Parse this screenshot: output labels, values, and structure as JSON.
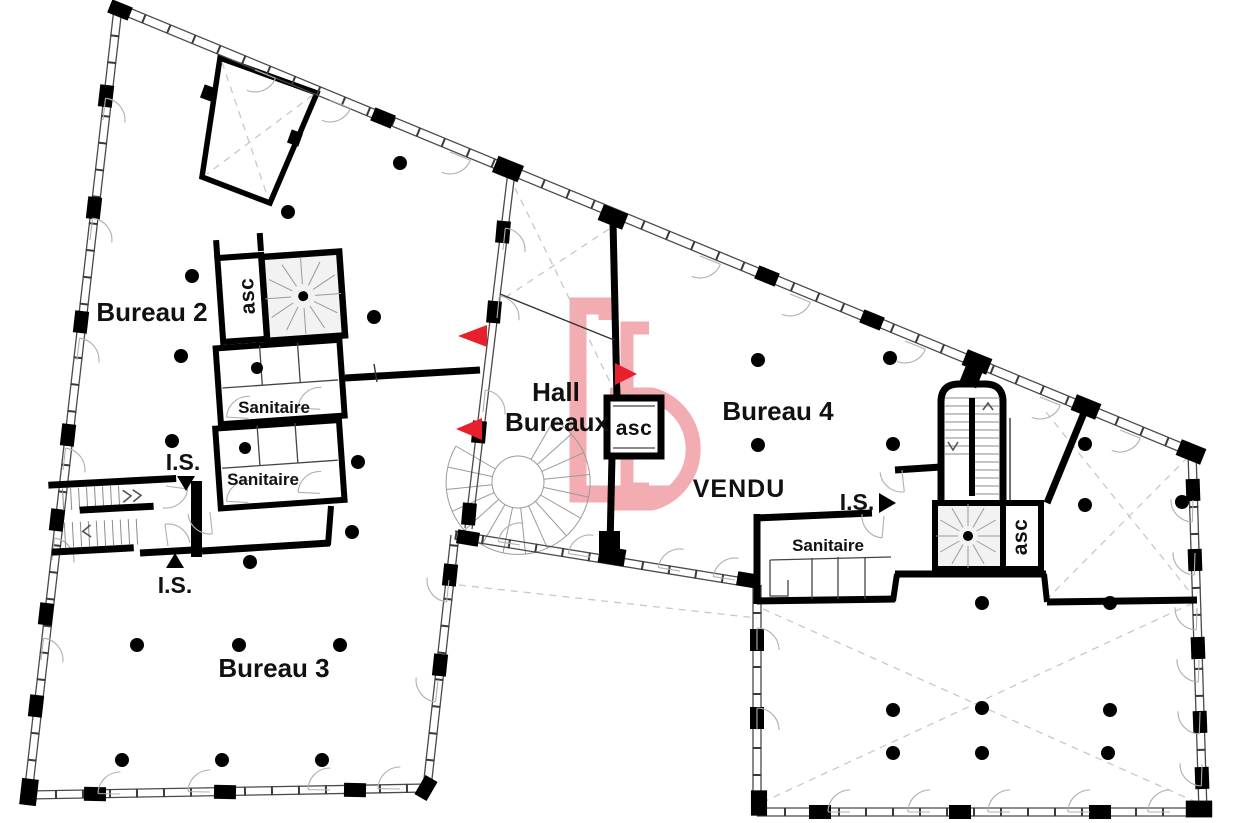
{
  "title": "Plan d'étage bureaux",
  "colors": {
    "wall": "#000000",
    "window_line": "#4a4a4a",
    "dash": "#c8c8c8",
    "stair_fill": "#f2f2f2",
    "logo_pink": "#f2a6ab",
    "vendu_red": "#d9333f",
    "arrow_red": "#e8202e"
  },
  "rooms": {
    "bureau2": "Bureau 2",
    "bureau3": "Bureau 3",
    "bureau4": "Bureau 4",
    "hall_line1": "Hall",
    "hall_line2": "Bureaux"
  },
  "labels": {
    "sanitaire": "Sanitaire",
    "is": "I.S.",
    "asc": "asc"
  },
  "watermark": {
    "vendu": "VENDU"
  }
}
